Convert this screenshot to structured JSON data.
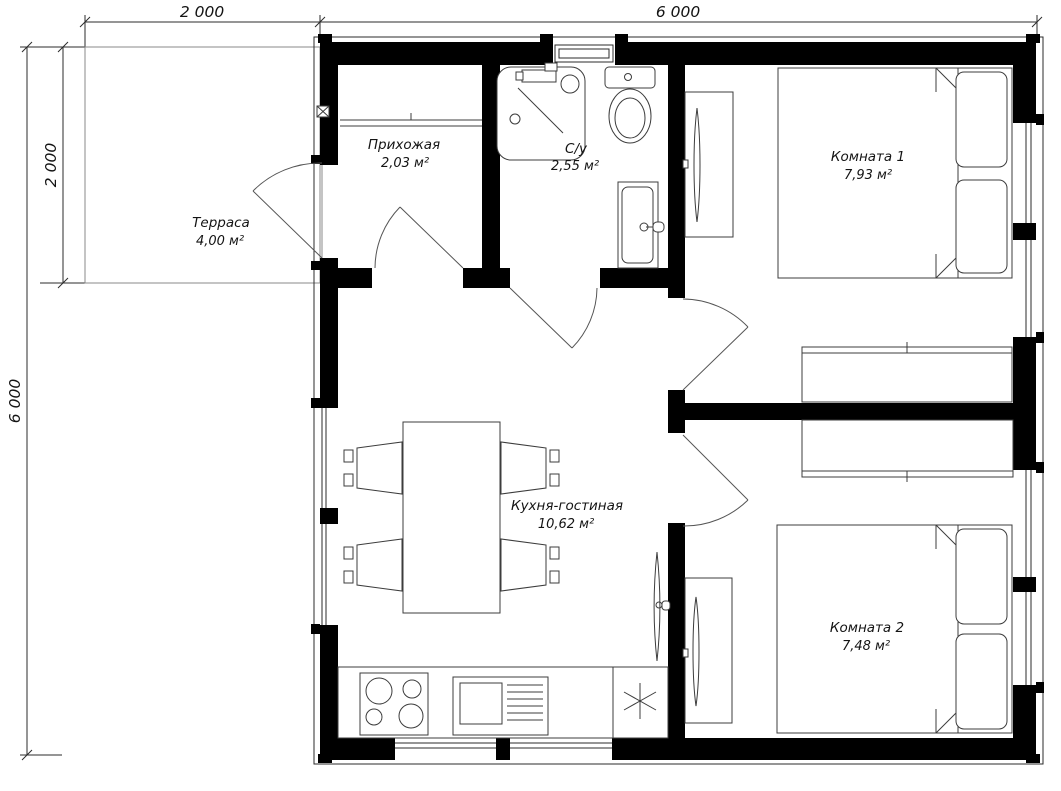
{
  "title": "Floor plan 6000x6000 with terrace",
  "dimensions": {
    "top_terrace": "2 000",
    "top_house": "6 000",
    "left_house": "6 000",
    "left_terrace": "2 000"
  },
  "rooms": {
    "terrace": {
      "name": "Терраса",
      "area": "4,00 м²"
    },
    "hallway": {
      "name": "Прихожая",
      "area": "2,03 м²"
    },
    "bathroom": {
      "name": "С/у",
      "area": "2,55 м²"
    },
    "room1": {
      "name": "Комната 1",
      "area": "7,93 м²"
    },
    "kitchen": {
      "name": "Кухня-гостиная",
      "area": "10,62 м²"
    },
    "room2": {
      "name": "Комната 2",
      "area": "7,48 м²"
    }
  },
  "symbols": {
    "fridge": "asterisk-snowflake",
    "stove": "four-burner-circles",
    "doors": "quarter-arc-swing"
  },
  "colors": {
    "walls": "#000000",
    "lines": "#3c3c3c",
    "background": "#ffffff"
  }
}
